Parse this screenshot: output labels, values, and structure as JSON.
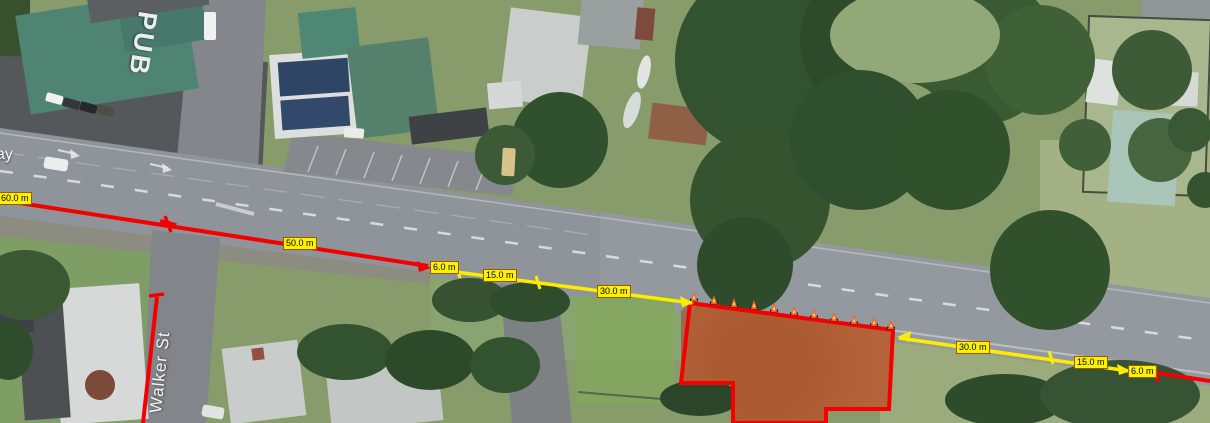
{
  "map_labels": {
    "road_name_partial": "ay",
    "street_name": "Walker St",
    "building_name": "PUB"
  },
  "annotations": {
    "measurements_left": [
      {
        "id": "left-60",
        "text": "60.0 m"
      },
      {
        "id": "left-50",
        "text": "50.0 m"
      },
      {
        "id": "left-6",
        "text": "6.0 m"
      },
      {
        "id": "left-15",
        "text": "15.0 m"
      },
      {
        "id": "left-30",
        "text": "30.0 m"
      }
    ],
    "measurements_right": [
      {
        "id": "right-30",
        "text": "30.0 m"
      },
      {
        "id": "right-15",
        "text": "15.0 m"
      },
      {
        "id": "right-6",
        "text": "6.0 m"
      }
    ],
    "work_zone": {
      "cone_count": 11
    }
  },
  "colors": {
    "measure_red": "#f40000",
    "measure_yellow": "#fced00",
    "label_bg": "#fcf003",
    "label_border": "#9c5a00",
    "label_text": "#000000",
    "work_zone_fill": "rgba(199,88,37,0.55)",
    "work_zone_border": "#f40000",
    "cone_color": "#ff5f00",
    "map_text": "#f5f5f5"
  }
}
